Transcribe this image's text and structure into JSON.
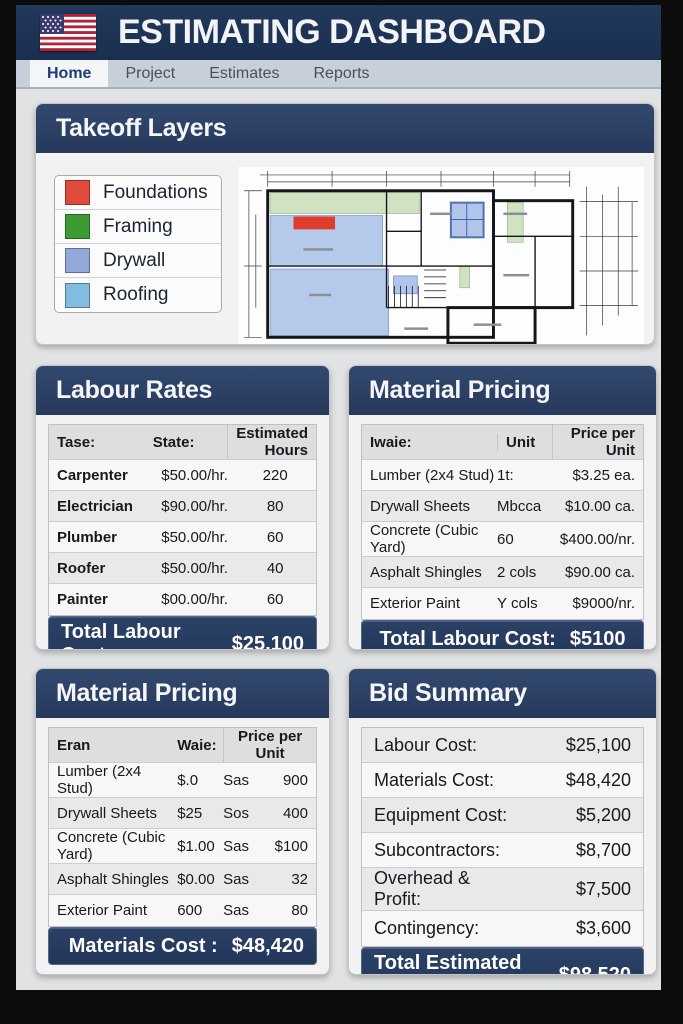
{
  "header": {
    "title": "ESTIMATING DASHBOARD",
    "flag_icon": "us-flag-icon"
  },
  "nav": {
    "tabs": [
      {
        "label": "Home",
        "active": true
      },
      {
        "label": "Project",
        "active": false
      },
      {
        "label": "Estimates",
        "active": false
      },
      {
        "label": "Reports",
        "active": false
      }
    ]
  },
  "takeoff": {
    "title": "Takeoff Layers",
    "legend": [
      {
        "label": "Foundations",
        "color": "#e14b3b"
      },
      {
        "label": "Framing",
        "color": "#3e9a33"
      },
      {
        "label": "Drywall",
        "color": "#93a9da"
      },
      {
        "label": "Roofing",
        "color": "#82bcdf"
      }
    ]
  },
  "labour": {
    "title": "Labour Rates",
    "columns": [
      "Tase:",
      "State:",
      "Estimated Hours"
    ],
    "rows": [
      [
        "Carpenter",
        "$50.00/hr.",
        "220"
      ],
      [
        "Electrician",
        "$90.00/hr.",
        "80"
      ],
      [
        "Plumber",
        "$50.00/hr.",
        "60"
      ],
      [
        "Roofer",
        "$50.00/hr.",
        "40"
      ],
      [
        "Painter",
        "$00.00/hr.",
        "60"
      ]
    ],
    "total_label": "Total Labour Cost:",
    "total_value": "$25,100"
  },
  "material_top": {
    "title": "Material Pricing",
    "columns": [
      "Iwaie:",
      "Unit",
      "Price per Unit"
    ],
    "rows": [
      [
        "Lumber (2x4 Stud)",
        "1t:",
        "$3.25 ea."
      ],
      [
        "Drywall Sheets",
        "Mbcca",
        "$10.00 ca."
      ],
      [
        "Concrete (Cubic Yard)",
        "60",
        "$400.00/nr."
      ],
      [
        "Asphalt Shingles",
        "2 cols",
        "$90.00 ca."
      ],
      [
        "Exterior Paint",
        "Y cols",
        "$9000/nr."
      ]
    ],
    "total_label": "Total Labour Cost:",
    "total_value": "$5100"
  },
  "material_bottom": {
    "title": "Material Pricing",
    "columns": [
      "Eran",
      "Waie:",
      "Price per Unit"
    ],
    "rows": [
      [
        "Lumber (2x4 Stud)",
        "$.0",
        "Sas",
        "900"
      ],
      [
        "Drywall Sheets",
        "$25",
        "Sos",
        "400"
      ],
      [
        "Concrete (Cubic Yard)",
        "$1.00",
        "Sas",
        "$100"
      ],
      [
        "Asphalt Shingles",
        "$0.00",
        "Sas",
        "32"
      ],
      [
        "Exterior Paint",
        "600",
        "Sas",
        "80"
      ]
    ],
    "total_label": "Materials Cost :",
    "total_value": "$48,420"
  },
  "bid": {
    "title": "Bid Summary",
    "rows": [
      {
        "label": "Labour Cost:",
        "value": "$25,100"
      },
      {
        "label": "Materials Cost:",
        "value": "$48,420"
      },
      {
        "label": "Equipment Cost:",
        "value": "$5,200"
      },
      {
        "label": "Subcontractors:",
        "value": "$8,700"
      },
      {
        "label": "Overhead & Profit:",
        "value": "$7,500"
      },
      {
        "label": "Contingency:",
        "value": "$3,600"
      }
    ],
    "total_label": "Total Estimated Cost:",
    "total_value": "$98,520"
  },
  "colors": {
    "header_navy": "#1d3456",
    "panel_navy": "#2c4368",
    "total_bar_navy": "#24395e",
    "nav_bar": "#c7d0da",
    "active_tab_text": "#1d3e74",
    "screen_bg": "#e0e2e3",
    "legend_red": "#e14b3b",
    "legend_green": "#3e9a33",
    "legend_periwinkle": "#93a9da",
    "legend_lightblue": "#82bcdf"
  }
}
